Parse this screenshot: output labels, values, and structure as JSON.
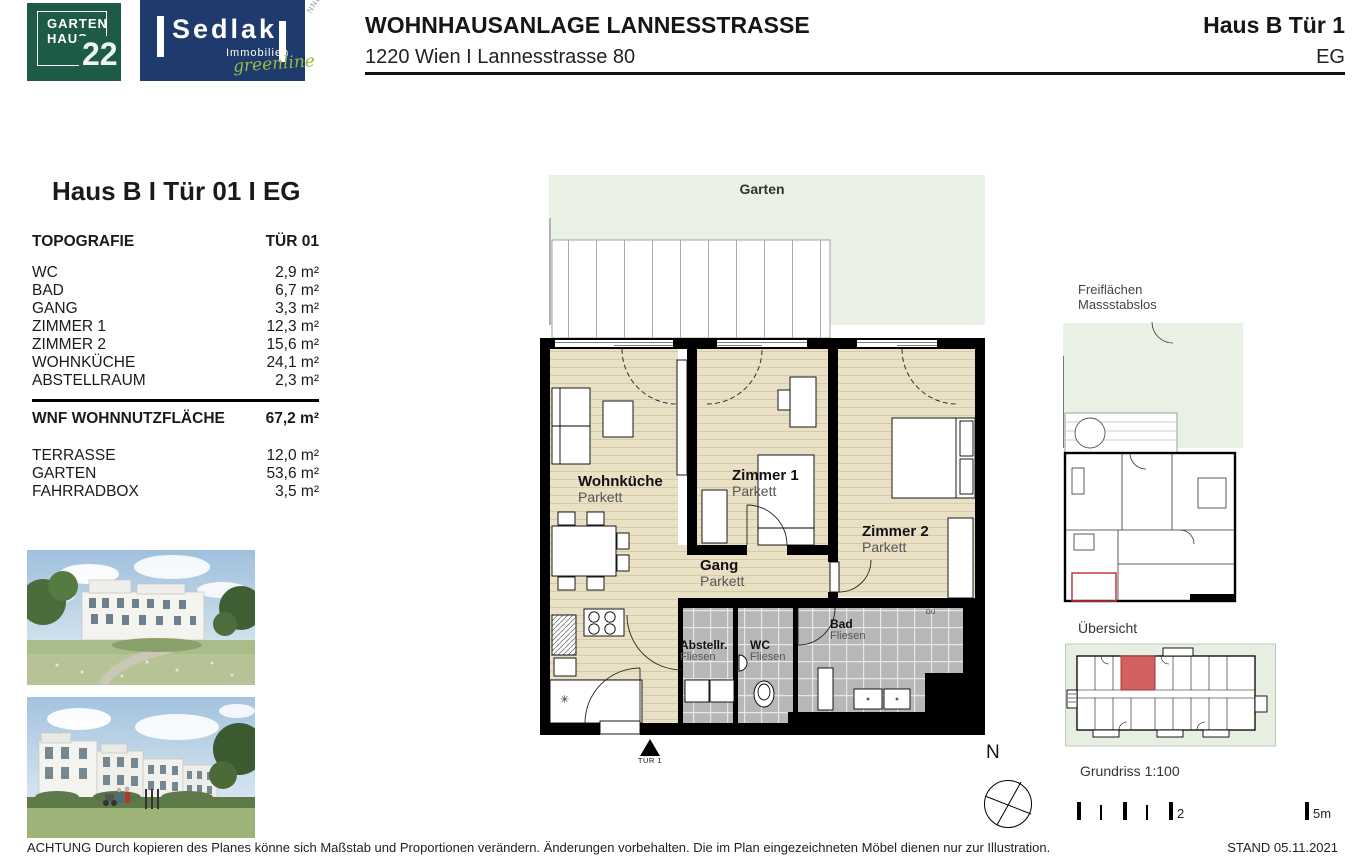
{
  "header": {
    "project_title": "WOHNHAUSANLAGE LANNESSTRASSE",
    "project_address": "1220 Wien I Lannesstrasse 80",
    "unit_title": "Haus B Tür 1",
    "unit_floor": "EG",
    "stamp_text": "NNECT"
  },
  "logos": {
    "gartenhaus": {
      "word1": "GARTEN",
      "word2": "HAUS",
      "number": "22"
    },
    "sedlak": {
      "name": "Sedlak",
      "subtitle": "Immobilien",
      "tagline": "greenline"
    }
  },
  "info_panel": {
    "heading": "Haus B I Tür 01 I EG",
    "columns": {
      "left": "TOPOGRAFIE",
      "right": "TÜR 01"
    },
    "rooms": [
      {
        "label": "WC",
        "area": "2,9 m²"
      },
      {
        "label": "BAD",
        "area": "6,7 m²"
      },
      {
        "label": "GANG",
        "area": "3,3 m²"
      },
      {
        "label": "ZIMMER 1",
        "area": "12,3 m²"
      },
      {
        "label": "ZIMMER 2",
        "area": "15,6 m²"
      },
      {
        "label": "WOHNKÜCHE",
        "area": "24,1 m²"
      },
      {
        "label": "ABSTELLRAUM",
        "area": "2,3 m²"
      }
    ],
    "total": {
      "label": "WNF WOHNNUTZFLÄCHE",
      "area": "67,2 m²"
    },
    "outdoor": [
      {
        "label": "TERRASSE",
        "area": "12,0 m²"
      },
      {
        "label": "GARTEN",
        "area": "53,6 m²"
      },
      {
        "label": "FAHRRADBOX",
        "area": "3,5 m²"
      }
    ]
  },
  "floorplan": {
    "garden_label": "Garten",
    "rooms": [
      {
        "name": "Wohnküche",
        "floor": "Parkett"
      },
      {
        "name": "Zimmer 1",
        "floor": "Parkett"
      },
      {
        "name": "Zimmer 2",
        "floor": "Parkett"
      },
      {
        "name": "Gang",
        "floor": "Parkett"
      },
      {
        "name": "Abstellr.",
        "floor": "Fliesen"
      },
      {
        "name": "WC",
        "floor": "Fliesen"
      },
      {
        "name": "Bad",
        "floor": "Fliesen"
      }
    ],
    "duct_label": "DU",
    "entry_label": "TÜR 1"
  },
  "side_panel": {
    "freiflaechen_line1": "Freiflächen",
    "freiflaechen_line2": "Massstabslos",
    "uebersicht_label": "Übersicht",
    "compass_label": "N",
    "scale_title": "Grundriss 1:100",
    "scale_mid_label": "2",
    "scale_end_label": "5m"
  },
  "footer": {
    "disclaimer": "ACHTUNG Durch kopieren des Planes könne sich Maßstab und Proportionen verändern. Änderungen vorbehalten. Die im Plan eingezeichneten Möbel dienen nur zur Illustration.",
    "stand": "STAND 05.11.2021"
  },
  "colors": {
    "logo_green": "#1d5a48",
    "logo_navy": "#1f3a6d",
    "tagline_green": "#97ba40",
    "garden_green": "#e9f1e4",
    "parquet": "#eae0c6",
    "parquet_stripe": "#d8caa5",
    "tile_gray": "#b7b7b7",
    "wall_black": "#000000",
    "unit_red": "#d45f5f"
  }
}
